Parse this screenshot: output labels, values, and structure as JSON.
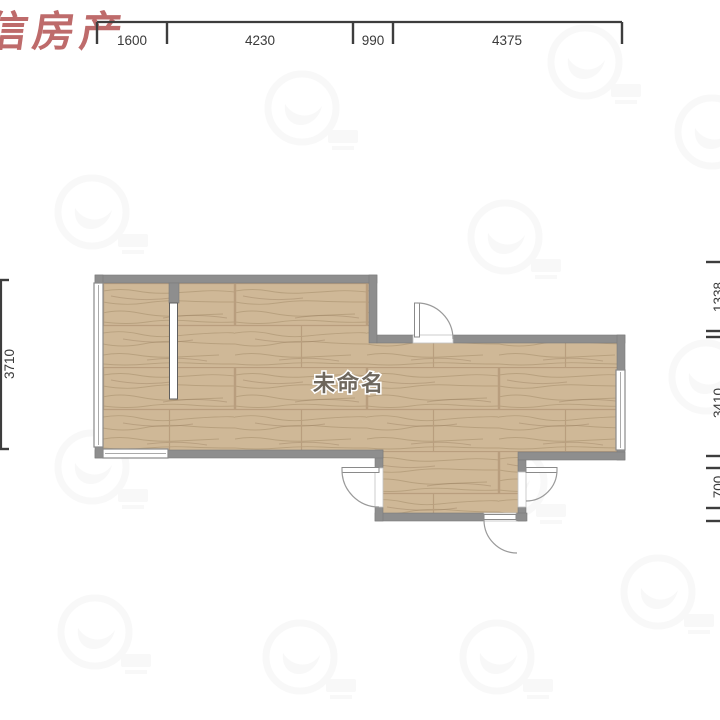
{
  "brand_watermark": {
    "text": "信房产",
    "color": "#b35252"
  },
  "room": {
    "name": "未命名",
    "label_color": "#6e675d"
  },
  "dimensions": {
    "top": [
      "1600",
      "4230",
      "990",
      "4375"
    ],
    "left": [
      "3710"
    ],
    "right": [
      "1338",
      "3410",
      "700"
    ]
  },
  "colors": {
    "wall": "#8e8e8e",
    "floor": "#cfb897",
    "dimension_text": "#3a3a3a",
    "watermark_gray": "#888888"
  }
}
